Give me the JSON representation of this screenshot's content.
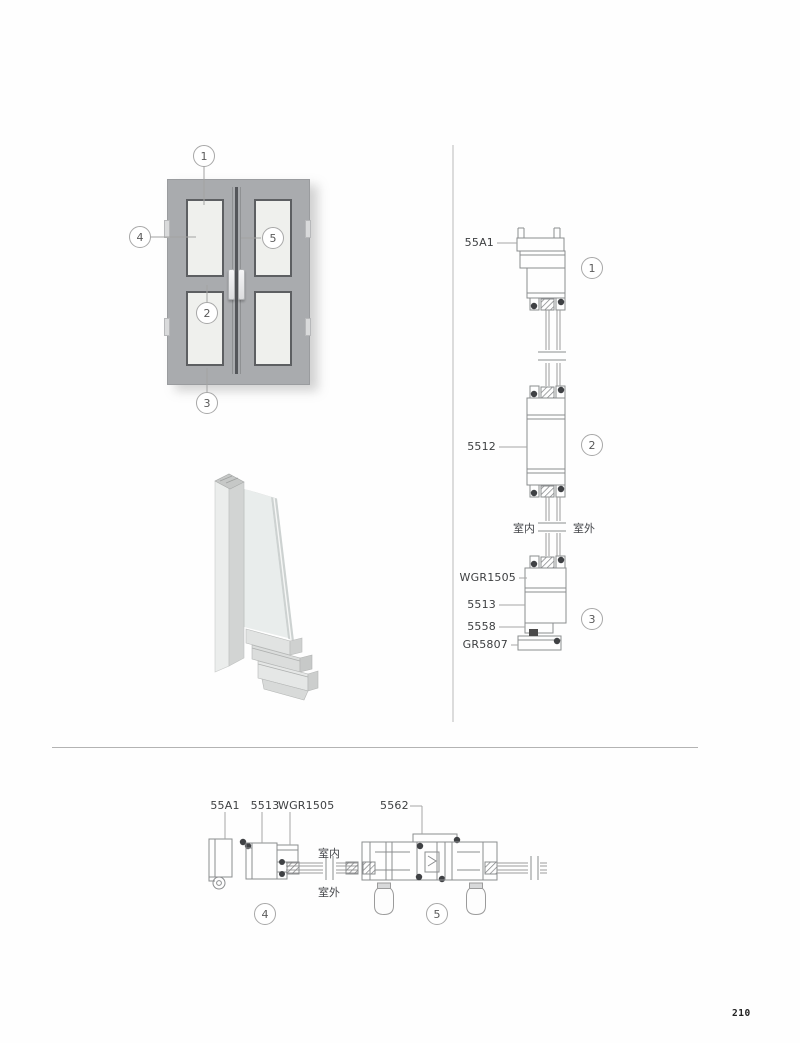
{
  "page_number": "210",
  "callouts": {
    "n1": "1",
    "n2": "2",
    "n3": "3",
    "n4": "4",
    "n5": "5"
  },
  "vertical_section": {
    "head_frame": "55A1",
    "transom": "5512",
    "glazing_bead": "WGR1505",
    "bottom_frame": "5513",
    "connector": "5558",
    "sill": "GR5807",
    "indoor": "室内",
    "outdoor": "室外"
  },
  "horizontal_section": {
    "jamb_frame": "55A1",
    "sash": "5513",
    "glazing_bead": "WGR1505",
    "interlock": "5562",
    "indoor": "室内",
    "outdoor": "室外"
  },
  "colors": {
    "frame_gray": "#a9abae",
    "glass_light": "#eff0ed",
    "line_gray": "#8b8d8f",
    "gasket_dark": "#3f4144"
  }
}
